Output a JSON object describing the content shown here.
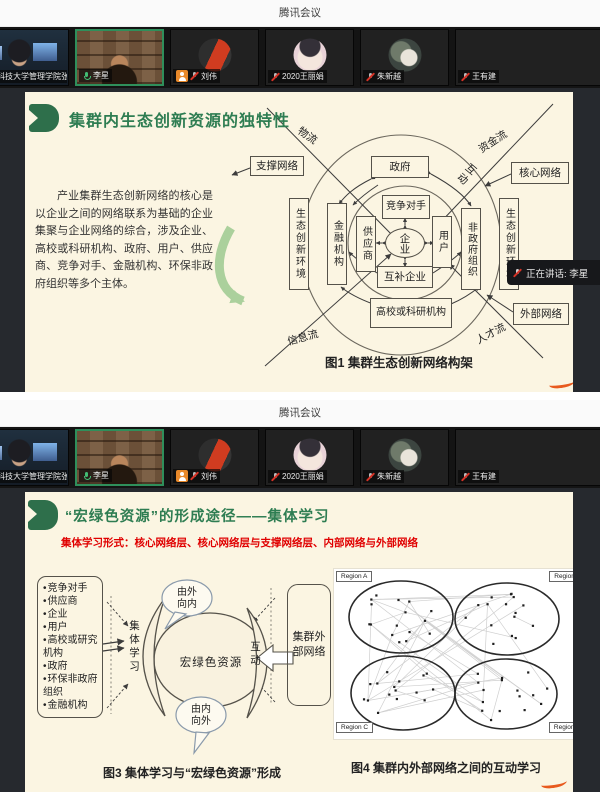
{
  "app": {
    "title": "腾讯会议"
  },
  "toast": {
    "text": "正在讲话: 李星"
  },
  "participants": [
    {
      "name": "科技大学管理学院张倩"
    },
    {
      "name": "李星"
    },
    {
      "name": "刘伟"
    },
    {
      "name": "2020王丽娟"
    },
    {
      "name": "朱新越"
    },
    {
      "name": "王有建"
    }
  ],
  "slide1": {
    "title": "集群内生态创新资源的独特性",
    "paragraph": "产业集群生态创新网络的核心是以企业之间的网络联系为基础的企业集聚与企业网络的综合，涉及企业、高校或科研机构、政府、用户、供应商、竞争对手、金融机构、环保非政府组织等多个主体。",
    "caption": "图1 集群生态创新网络构架",
    "diagram": {
      "support_network": "支撑网络",
      "government": "政府",
      "core_network": "核心网络",
      "competitor": "竞争对手",
      "eco_env_left": "生态创新环境",
      "finance": "金融机构",
      "supplier": "供应商",
      "enterprise": "企业",
      "user": "用户",
      "ngo": "非政府组织",
      "eco_env_right": "生态创新环境",
      "complementary": "互补企业",
      "university": "高校或科研机构",
      "external_network": "外部网络",
      "flow_logistics": "物流",
      "flow_capital": "资金流",
      "flow_info": "信息流",
      "flow_talent": "人才流",
      "interaction": "互动"
    }
  },
  "slide2": {
    "title": "“宏绿色资源”的形成途径——集体学习",
    "subtitle": "集体学习形式：核心网络层、核心网络层与支撑网络层、内部网络与外部网络",
    "actors": [
      "竞争对手",
      "供应商",
      "企业",
      "用户",
      "高校或研究机构",
      "政府",
      "环保非政府组织",
      "金融机构"
    ],
    "collective_learning": "集体学习",
    "resource": "宏绿色资源",
    "bubble_top": "由外向内",
    "bubble_bottom": "由内向外",
    "interaction": "互动",
    "external_network": "集群外部网络",
    "regions": [
      "Region A",
      "Region B",
      "Region C",
      "Region D"
    ],
    "caption_left": "图3 集体学习与“宏绿色资源”形成",
    "caption_right": "图4 集群内外部网络之间的互动学习"
  },
  "colors": {
    "accent_green": "#2e7d52",
    "accent_red": "#e00000",
    "slide_bg": "#fbf5e2"
  }
}
